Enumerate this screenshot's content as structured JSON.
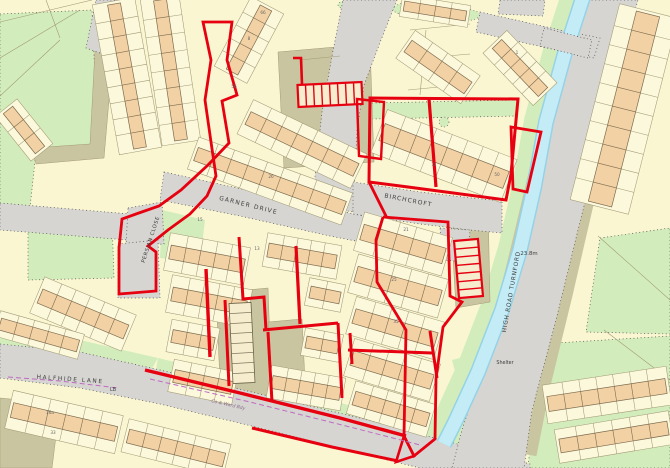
{
  "title": "OS site plan - Turnford",
  "colors": {
    "parcel": "#faf6d2",
    "parcel_light": "#fbf8dc",
    "building": "#f2d2a4",
    "building_edge": "#7d6b4f",
    "road": "#d6d5d2",
    "khaki": "#c9c5a0",
    "green": "#d2edbb",
    "water": "#c4ecf7",
    "water_edge": "#96d2e6",
    "boundary_red": "#e60010",
    "boundary_magenta": "#c06ac0",
    "line": "#a39a75",
    "dots": "#4a4a4a",
    "text": "#3d3d3d"
  },
  "map": {
    "street_labels": [
      {
        "text": "GARNER DRIVE",
        "x": 248,
        "y": 207,
        "rot": 14,
        "size": 6,
        "sp": 1.2
      },
      {
        "text": "BIRCHCROFT",
        "x": 408,
        "y": 202,
        "rot": 11,
        "size": 6,
        "sp": 1
      },
      {
        "text": "PERSIAN CLOSE",
        "x": 152,
        "y": 240,
        "rot": -72,
        "size": 5.2,
        "sp": 0.6
      },
      {
        "text": "HIGH ROAD TURNFORD",
        "x": 513,
        "y": 292,
        "rot": -80,
        "size": 5.8,
        "sp": 0.8
      },
      {
        "text": "HALFHIDE LANE",
        "x": 70,
        "y": 381,
        "rot": 4,
        "size": 5.8,
        "sp": 1.6
      }
    ],
    "annotations": [
      {
        "text": "23.8m",
        "x": 529,
        "y": 255,
        "rot": 0,
        "size": 5.4,
        "color": "#3d3d3d"
      },
      {
        "text": "Shelter",
        "x": 505,
        "y": 364,
        "rot": 0,
        "size": 4.8,
        "color": "#3d3d3d"
      },
      {
        "text": "LB",
        "x": 113,
        "y": 391,
        "rot": 0,
        "size": 4.8,
        "color": "#3d3d3d"
      },
      {
        "text": "Co & Ward Bdy",
        "x": 228,
        "y": 406,
        "rot": 13,
        "size": 4.6,
        "color": "#8a6f8a",
        "italic": true
      }
    ],
    "house_numbers": [
      {
        "text": "26",
        "x": 271,
        "y": 178
      },
      {
        "text": "15",
        "x": 200,
        "y": 221
      },
      {
        "text": "13",
        "x": 257,
        "y": 250
      },
      {
        "text": "11",
        "x": 434,
        "y": 166
      },
      {
        "text": "50",
        "x": 497,
        "y": 176
      },
      {
        "text": "21",
        "x": 406,
        "y": 231
      },
      {
        "text": "25",
        "x": 394,
        "y": 281
      },
      {
        "text": "35",
        "x": 396,
        "y": 323
      },
      {
        "text": "66",
        "x": 263,
        "y": 14
      },
      {
        "text": "56",
        "x": 234,
        "y": 88
      },
      {
        "text": "8",
        "x": 249,
        "y": 40
      },
      {
        "text": "1",
        "x": 517,
        "y": 54
      },
      {
        "text": "16a",
        "x": 50,
        "y": 414
      },
      {
        "text": "33",
        "x": 53,
        "y": 434
      }
    ],
    "greens": [
      {
        "d": "M0,14 L92,10 L98,146 L36,152 L28,226 L0,228 Z",
        "dash": true
      },
      {
        "d": "M28,222 L112,220 L114,278 L28,280 Z",
        "dash": true
      },
      {
        "d": "M372,103 L518,100 L517,116 L372,119 Z",
        "dash": true
      },
      {
        "d": "M162,210 L205,220 L200,262 L160,258 Z",
        "dash": false
      },
      {
        "d": "M600,238 L670,228 L670,334 L586,332 Z",
        "dash": true
      },
      {
        "d": "M540,344 L670,336 L670,468 L528,468 Z",
        "dash": true
      },
      {
        "d": "M452,360 L530,340 L522,430 L508,468 L462,468 L470,428 Z",
        "dash": false
      },
      {
        "d": "M0,332 L80,340 L158,358 L150,372 L78,352 L0,346 Z",
        "dash": false
      },
      {
        "d": "M158,358 L260,382 L360,408 L430,426 L428,436 L256,392 L156,370 Z",
        "dash": false
      }
    ],
    "green_ellipses": [
      {
        "cx": 415,
        "cy": 9,
        "rx": 22,
        "ry": 7
      },
      {
        "cx": 462,
        "cy": 15,
        "rx": 18,
        "ry": 6
      },
      {
        "cx": 352,
        "cy": 5,
        "rx": 14,
        "ry": 5
      },
      {
        "cx": 444,
        "cy": 122,
        "rx": 5,
        "ry": 5
      },
      {
        "cx": 297,
        "cy": 91,
        "rx": 4,
        "ry": 4
      },
      {
        "cx": 250,
        "cy": 183,
        "rx": 4,
        "ry": 4
      }
    ],
    "khakis": [
      {
        "d": "M278,52 L370,44 L374,162 L284,168 Z"
      },
      {
        "d": "M450,206 L488,202 L490,302 L456,308 Z"
      },
      {
        "d": "M216,293 L268,288 L272,400 L221,404 Z"
      },
      {
        "d": "M268,322 L302,319 L306,402 L272,406 Z"
      },
      {
        "d": "M95,50 L113,54 L104,158 L36,164 L32,148 L90,144 Z"
      },
      {
        "d": "M0,398 L60,404 L52,468 L0,468 Z"
      }
    ],
    "verges": [
      {
        "pts": "584,8 556,90 534,180 514,264 492,350 468,436",
        "w": 14
      },
      {
        "pts": "634,18 610,110 588,200 566,295 544,385 530,455",
        "w": 13
      }
    ],
    "stream_banks": {
      "pts": "584,-6 564,56 546,122 534,188 520,250 502,310 478,372 456,420 444,446",
      "w": 44
    },
    "roads": [
      {
        "d": "M0,344 L80,352 L160,370 L260,394 L360,418 L450,442 L530,464 L530,468 L420,468 L355,452 L260,428 L160,404 L80,388 L0,378 Z"
      },
      {
        "d": "M588,0 L638,0 L618,70 L598,150 L578,230 L556,320 L532,410 L524,468 L452,468 L462,430 L485,360 L508,280 L528,200 L545,130 L565,60 Z"
      },
      {
        "d": "M0,203 L130,214 L128,240 L0,230 Z"
      },
      {
        "d": "M128,208 L162,202 L164,244 L126,246 Z"
      },
      {
        "d": "M118,244 L158,240 L160,298 L118,298 Z"
      },
      {
        "d": "M164,172 L210,182 L300,202 L390,222 L392,248 L330,236 L240,216 L160,200 Z"
      },
      {
        "d": "M343,0 L397,0 L381,40 L364,85 L357,130 L355,175 L353,212 L312,204 L317,158 L322,112 L332,56 Z"
      },
      {
        "d": "M353,182 L420,192 L472,198 L502,201 L502,233 L470,230 L420,224 L353,214 Z"
      },
      {
        "d": "M440,228 L470,230 L468,262 L442,260 Z"
      },
      {
        "d": "M96,0 L132,0 L114,58 L86,48 Z"
      },
      {
        "d": "M480,12 L560,30 L600,38 L594,58 L556,50 L476,32 Z"
      },
      {
        "d": "M500,0 L545,0 L543,16 L498,14 Z"
      }
    ],
    "stream": {
      "pts": "584,-6 564,56 546,122 534,188 520,250 502,310 478,372 456,420 444,444"
    },
    "bridge": {
      "d": "M544,28 L592,40 L588,58 L540,46 Z"
    },
    "parcel_lines": [
      [
        0,
        22,
        92,
        0
      ],
      [
        0,
        58,
        80,
        10
      ],
      [
        0,
        96,
        60,
        40
      ],
      [
        46,
        0,
        60,
        38
      ],
      [
        598,
        236,
        670,
        300
      ],
      [
        604,
        330,
        670,
        380
      ],
      [
        300,
        60,
        340,
        56
      ],
      [
        410,
        30,
        470,
        24
      ],
      [
        400,
        60,
        470,
        54
      ],
      [
        408,
        90,
        470,
        84
      ],
      [
        420,
        95,
        426,
        30
      ]
    ],
    "blocks": [
      {
        "x1": 114,
        "y1": 4,
        "x2": 140,
        "y2": 148,
        "d": 13,
        "g": 15,
        "u": 9
      },
      {
        "x1": 160,
        "y1": 0,
        "x2": 181,
        "y2": 140,
        "d": 13,
        "g": 13,
        "u": 8
      },
      {
        "x1": 8,
        "y1": 110,
        "x2": 40,
        "y2": 150,
        "d": 12,
        "g": 8,
        "u": 3
      },
      {
        "x1": 232,
        "y1": 72,
        "x2": 266,
        "y2": 8,
        "d": 13,
        "g": 12,
        "u": 5
      },
      {
        "x1": 248,
        "y1": 118,
        "x2": 356,
        "y2": 170,
        "d": 14,
        "g": 12,
        "u": 7
      },
      {
        "x1": 196,
        "y1": 154,
        "x2": 344,
        "y2": 208,
        "d": 14,
        "g": 10,
        "u": 9
      },
      {
        "x1": 382,
        "y1": 132,
        "x2": 506,
        "y2": 180,
        "d": 18,
        "g": 14,
        "u": 8
      },
      {
        "x1": 497,
        "y1": 44,
        "x2": 543,
        "y2": 92,
        "d": 13,
        "g": 10,
        "u": 5
      },
      {
        "x1": 408,
        "y1": 46,
        "x2": 468,
        "y2": 88,
        "d": 14,
        "g": 10,
        "u": 4
      },
      {
        "x1": 404,
        "y1": 6,
        "x2": 466,
        "y2": 16,
        "d": 10,
        "g": 6,
        "u": 4
      },
      {
        "x1": 40,
        "y1": 296,
        "x2": 126,
        "y2": 332,
        "d": 15,
        "g": 12,
        "u": 6
      },
      {
        "x1": 0,
        "y1": 324,
        "x2": 78,
        "y2": 346,
        "d": 12,
        "g": 7,
        "u": 5
      },
      {
        "x1": 170,
        "y1": 252,
        "x2": 244,
        "y2": 266,
        "d": 14,
        "g": 12,
        "u": 5
      },
      {
        "x1": 172,
        "y1": 294,
        "x2": 246,
        "y2": 308,
        "d": 14,
        "g": 12,
        "u": 5
      },
      {
        "x1": 172,
        "y1": 336,
        "x2": 214,
        "y2": 344,
        "d": 13,
        "g": 10,
        "u": 3
      },
      {
        "x1": 174,
        "y1": 376,
        "x2": 232,
        "y2": 388,
        "d": 13,
        "g": 10,
        "u": 4
      },
      {
        "x1": 268,
        "y1": 250,
        "x2": 336,
        "y2": 262,
        "d": 14,
        "g": 10,
        "u": 5
      },
      {
        "x1": 310,
        "y1": 292,
        "x2": 340,
        "y2": 298,
        "d": 12,
        "g": 8,
        "u": 2
      },
      {
        "x1": 306,
        "y1": 342,
        "x2": 338,
        "y2": 348,
        "d": 12,
        "g": 8,
        "u": 2
      },
      {
        "x1": 272,
        "y1": 382,
        "x2": 340,
        "y2": 394,
        "d": 13,
        "g": 10,
        "u": 5
      },
      {
        "x1": 362,
        "y1": 232,
        "x2": 444,
        "y2": 256,
        "d": 16,
        "g": 12,
        "u": 5
      },
      {
        "x1": 356,
        "y1": 274,
        "x2": 440,
        "y2": 298,
        "d": 16,
        "g": 12,
        "u": 5
      },
      {
        "x1": 354,
        "y1": 316,
        "x2": 436,
        "y2": 340,
        "d": 15,
        "g": 12,
        "u": 5
      },
      {
        "x1": 352,
        "y1": 358,
        "x2": 432,
        "y2": 382,
        "d": 15,
        "g": 12,
        "u": 5
      },
      {
        "x1": 354,
        "y1": 398,
        "x2": 428,
        "y2": 420,
        "d": 14,
        "g": 10,
        "u": 5
      },
      {
        "x1": 648,
        "y1": 14,
        "x2": 600,
        "y2": 204,
        "d": 24,
        "g": 18,
        "u": 10
      },
      {
        "x1": 548,
        "y1": 404,
        "x2": 666,
        "y2": 386,
        "d": 15,
        "g": 12,
        "u": 7
      },
      {
        "x1": 560,
        "y1": 446,
        "x2": 668,
        "y2": 428,
        "d": 14,
        "g": 10,
        "u": 6
      },
      {
        "x1": 12,
        "y1": 410,
        "x2": 116,
        "y2": 434,
        "d": 15,
        "g": 12,
        "u": 6
      },
      {
        "x1": 128,
        "y1": 436,
        "x2": 224,
        "y2": 460,
        "d": 14,
        "g": 10,
        "u": 6
      }
    ],
    "ladders": [
      {
        "x1": 298,
        "y1": 96,
        "x2": 362,
        "y2": 93,
        "hw": 11,
        "n": 8,
        "red": true
      },
      {
        "x1": 466,
        "y1": 240,
        "x2": 471,
        "y2": 297,
        "hw": 12,
        "n": 7,
        "red": true
      },
      {
        "x1": 240,
        "y1": 303,
        "x2": 244,
        "y2": 383,
        "hw": 11,
        "n": 8,
        "red": false
      }
    ],
    "red_paths": [
      {
        "d": "M203,22 L232,22 L227,60 L237,95 L222,101 L229,143 L208,165 L181,190 L159,206 L136,214 L122,219 L119,248 L119,294 L156,291 L156,252 L148,246 L168,230 L190,214 L207,196 L216,176 L211,142 L205,100 L211,60 Z",
        "w": 2.8
      },
      {
        "d": "M293,58 L301,58 L302,84",
        "w": 2.6
      },
      {
        "d": "M370,98 L518,99 L511,174 L506,200 L408,187 L369,182 Z",
        "w": 3
      },
      {
        "d": "M429,99 L436,187",
        "w": 3.2
      },
      {
        "d": "M511,127 L541,132 L527,192 L513,189 Z",
        "w": 2.8
      },
      {
        "d": "M357,99 L384,102 L381,159 L359,156 Z",
        "w": 2.4
      },
      {
        "d": "M369,182 L387,218",
        "w": 2.8
      },
      {
        "d": "M383,217 L448,222 L450,296 L462,302 L443,327 L436,379 L435,439 L414,456 L404,436 L406,330 L377,282 L376,240 L383,217",
        "w": 2.8
      },
      {
        "d": "M350,333 L352,364",
        "w": 3
      },
      {
        "d": "M348,350 L432,353",
        "w": 3
      },
      {
        "d": "M430,331 L437,378",
        "w": 3
      },
      {
        "d": "M206,269 L210,357",
        "w": 3.4
      },
      {
        "d": "M239,237 L243,299 L264,297 L266,330",
        "w": 3
      },
      {
        "d": "M263,330 L338,323",
        "w": 3
      },
      {
        "d": "M296,246 L300,324",
        "w": 3.2
      },
      {
        "d": "M268,332 L272,402",
        "w": 3
      },
      {
        "d": "M338,323 L342,398",
        "w": 3
      },
      {
        "d": "M225,300 L229,386",
        "w": 3
      },
      {
        "d": "M145,370 L240,393 L340,418 L406,436",
        "w": 3.4
      },
      {
        "d": "M252,428 L332,447 L398,461",
        "w": 3
      },
      {
        "d": "M404,436 L414,456 L396,462 Z",
        "w": 2.6
      }
    ],
    "magenta_lines": [
      {
        "pts": "8,377 60,381 118,388"
      },
      {
        "pts": "150,379 250,402 350,427 420,445"
      }
    ]
  }
}
